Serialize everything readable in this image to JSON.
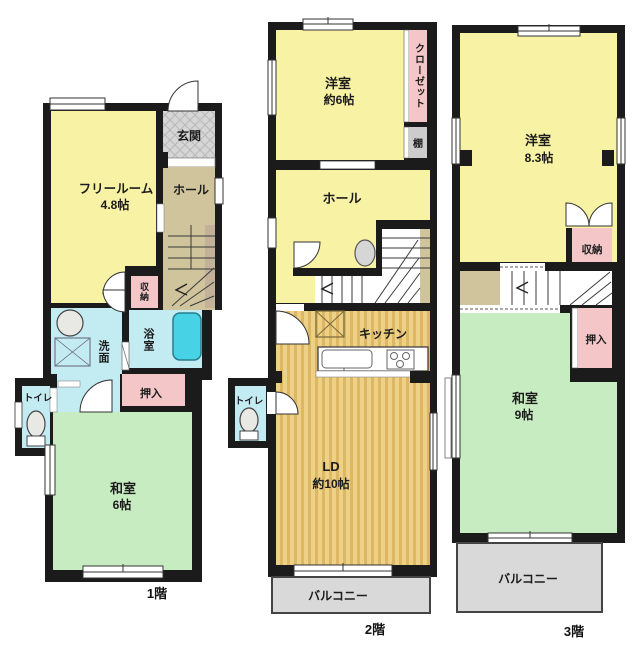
{
  "floors": [
    {
      "name": "1階",
      "rooms": {
        "free_room": {
          "label": "フリールーム",
          "size": "4.8帖"
        },
        "genkan": {
          "label": "玄関"
        },
        "hall": {
          "label": "ホール"
        },
        "shuno": {
          "label": "収納"
        },
        "yokushitsu": {
          "label": "浴室"
        },
        "senmen": {
          "label": "洗面"
        },
        "toilet": {
          "label": "トイレ"
        },
        "oshiire": {
          "label": "押入"
        },
        "washitsu": {
          "label": "和室",
          "size": "6帖"
        }
      }
    },
    {
      "name": "2階",
      "rooms": {
        "yoshitsu": {
          "label": "洋室",
          "size": "約6帖"
        },
        "closet": {
          "label": "クローゼット"
        },
        "tana": {
          "label": "棚"
        },
        "hall": {
          "label": "ホール"
        },
        "kitchen": {
          "label": "キッチン"
        },
        "toilet": {
          "label": "トイレ"
        },
        "ld": {
          "label": "LD",
          "size": "約10帖"
        },
        "balcony": {
          "label": "バルコニー"
        }
      }
    },
    {
      "name": "3階",
      "rooms": {
        "yoshitsu": {
          "label": "洋室",
          "size": "8.3帖"
        },
        "shuno": {
          "label": "収納"
        },
        "oshiire": {
          "label": "押入"
        },
        "washitsu": {
          "label": "和室",
          "size": "9帖"
        },
        "balcony": {
          "label": "バルコニー"
        }
      }
    }
  ],
  "colors": {
    "room_yellow": "#f8f3a4",
    "room_green": "#c8ecc1",
    "room_cyan": "#c3ebf2",
    "room_pink": "#f5c6c8",
    "hall_tan": "#cfc49c",
    "wood_floor": "#ecd187",
    "wood_stripe": "#dcb463",
    "balcony_gray": "#d9d9d9",
    "entrance_gray": "#d6d6d6",
    "shelf_gray": "#cccccc",
    "bathtub_blue": "#47d2e6",
    "wall": "#1b1b1b"
  }
}
